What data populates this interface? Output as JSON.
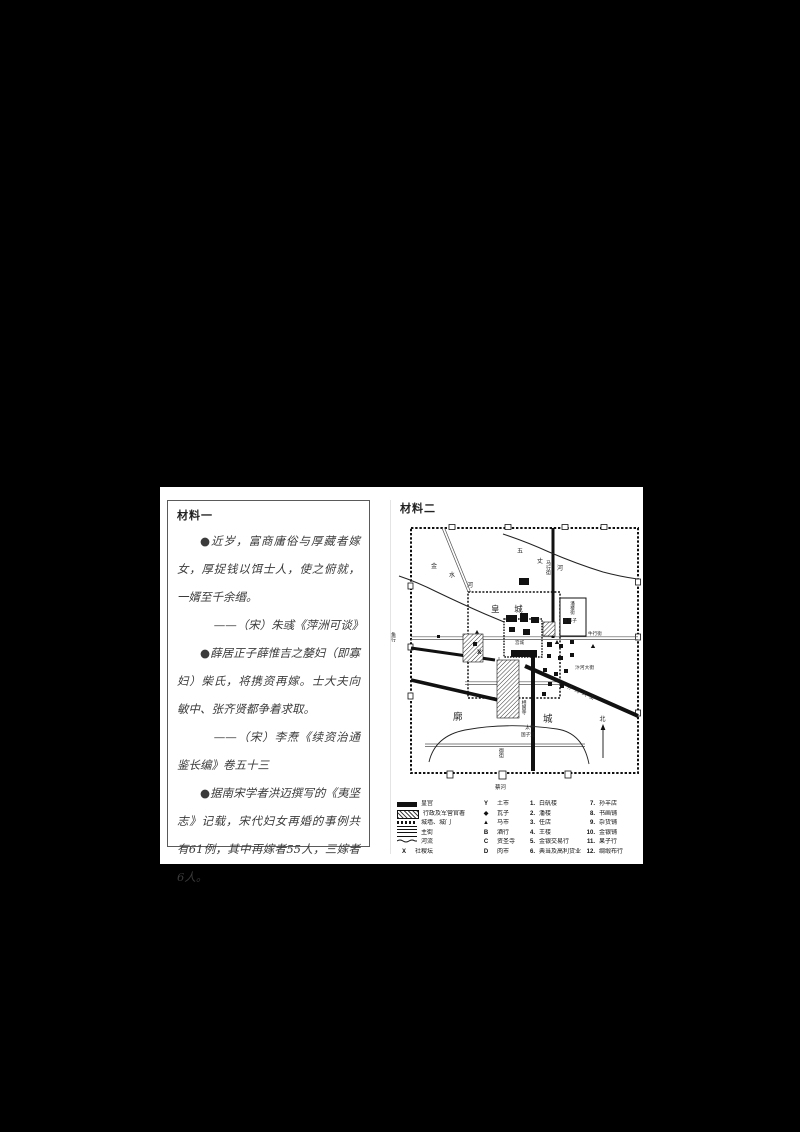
{
  "material1": {
    "title": "材料一",
    "paragraphs": [
      "●近岁，富商庸俗与厚藏者嫁女，厚捉钱以饵士人，使之俯就，一婿至千余缗。",
      "——（宋）朱彧《萍洲可谈》",
      "●薛居正子薛惟吉之嫠妇（即寡妇）柴氏，将携资再嫁。士大夫向敏中、张齐贤都争着求取。",
      "——（宋）李焘《续资治通鉴长编》卷五十三",
      "●据南宋学者洪迈撰写的《夷坚志》记载，宋代妇女再婚的事例共有61例，其中再嫁者55人，三嫁者6人。"
    ]
  },
  "material2": {
    "title": "材料二",
    "map_labels": {
      "huangcheng": "皇 城",
      "gongcheng": "宫城",
      "kuo": "廓",
      "cheng": "城",
      "jin": "金",
      "shui": "水",
      "he": "河",
      "wu": "五",
      "zhang": "丈",
      "he2": "河",
      "bianhe_dajie_h": "汴河大街",
      "bianhe_dajie_d": "汴河大街",
      "mahangjie": "马行街",
      "panloujie": "潘楼街",
      "guishizi": "鬼市子",
      "niuhangjie": "牛行街",
      "yuhang": "鱼行",
      "xiangguosi": "相国寺",
      "yujie": "御街",
      "taixue": "太学",
      "guozijian": "国子监",
      "caihe": "蔡河",
      "north": "北",
      "x_mark": "X"
    },
    "legend": {
      "col1": [
        {
          "label": "皇宫"
        },
        {
          "label": "行政及军营官署"
        },
        {
          "label": "城墙、城门"
        },
        {
          "label": "主街"
        },
        {
          "label": "河流"
        },
        {
          "symbol": "X",
          "label": "社稷坛"
        }
      ],
      "col2": [
        {
          "symbol": "Y",
          "label": "土市"
        },
        {
          "symbol": "◆",
          "label": "瓦子"
        },
        {
          "symbol": "▲",
          "label": "马市"
        },
        {
          "symbol": "B",
          "label": "酒行"
        },
        {
          "symbol": "C",
          "label": "资圣寺"
        },
        {
          "symbol": "D",
          "label": "肉市"
        }
      ],
      "col3": [
        {
          "num": "1.",
          "label": "白矾楼"
        },
        {
          "num": "2.",
          "label": "潘楼"
        },
        {
          "num": "3.",
          "label": "任店"
        },
        {
          "num": "4.",
          "label": "王楼"
        },
        {
          "num": "5.",
          "label": "金银交易行"
        },
        {
          "num": "6.",
          "label": "典当及高利贷业"
        }
      ],
      "col4": [
        {
          "num": "7.",
          "label": "孙羊店"
        },
        {
          "num": "8.",
          "label": "书画铺"
        },
        {
          "num": "9.",
          "label": "杂货铺"
        },
        {
          "num": "10.",
          "label": "金银铺"
        },
        {
          "num": "11.",
          "label": "果子行"
        },
        {
          "num": "12.",
          "label": "绸缎布行"
        }
      ]
    }
  }
}
